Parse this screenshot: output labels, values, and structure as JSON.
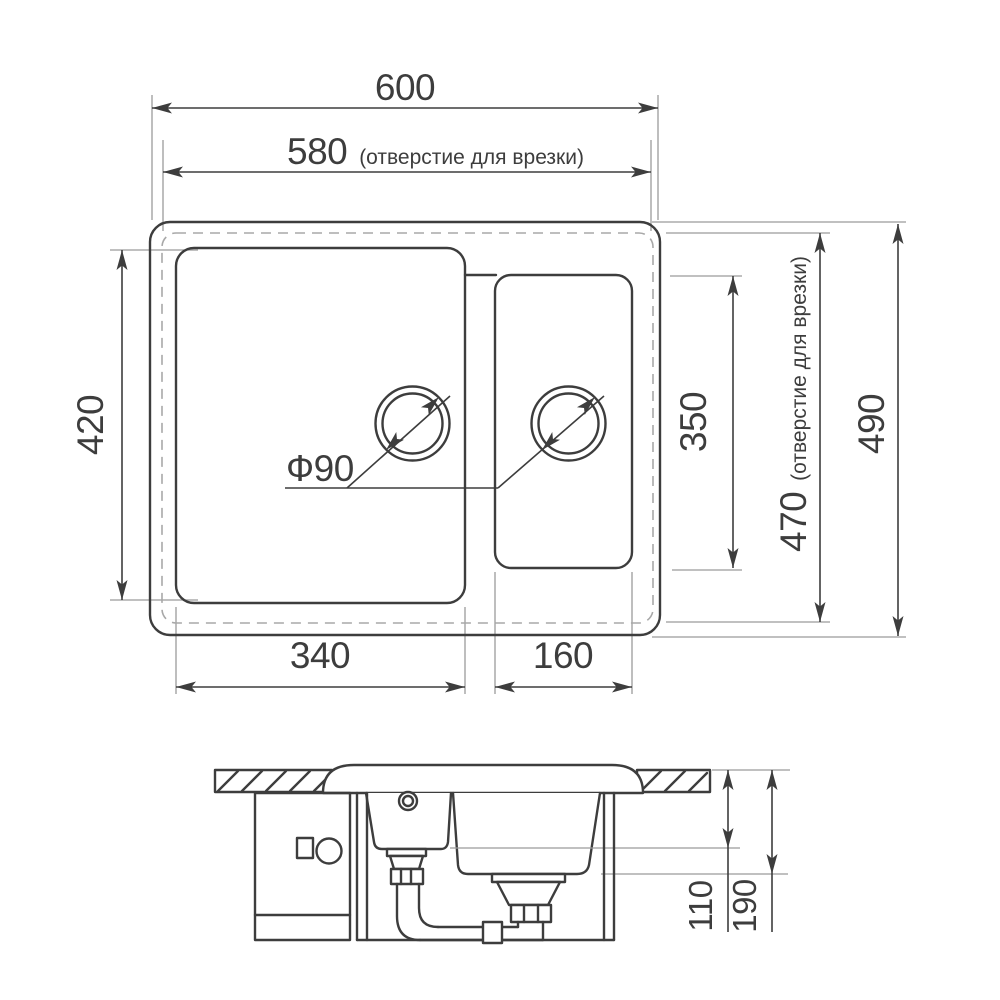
{
  "title": "Sink dimension drawing",
  "colors": {
    "line": "#3d3d3d",
    "thin_line": "#9b9b9b",
    "dashed_line": "#a8a8a8",
    "background": "#ffffff"
  },
  "top_view": {
    "dims": {
      "total_width": {
        "value": "600"
      },
      "cutout_width": {
        "value": "580",
        "note": "(отверстие для врезки)"
      },
      "left_bowl_height": {
        "value": "420"
      },
      "left_bowl_width": {
        "value": "340"
      },
      "right_bowl_width": {
        "value": "160"
      },
      "right_bowl_height": {
        "value": "350"
      },
      "cutout_height": {
        "value": "470",
        "note": "(отверстие для врезки)"
      },
      "total_height": {
        "value": "490"
      },
      "drain_diameter": {
        "value": "Ф90"
      }
    }
  },
  "section_view": {
    "dims": {
      "small_bowl_depth": {
        "value": "110"
      },
      "large_bowl_depth": {
        "value": "190"
      }
    }
  }
}
